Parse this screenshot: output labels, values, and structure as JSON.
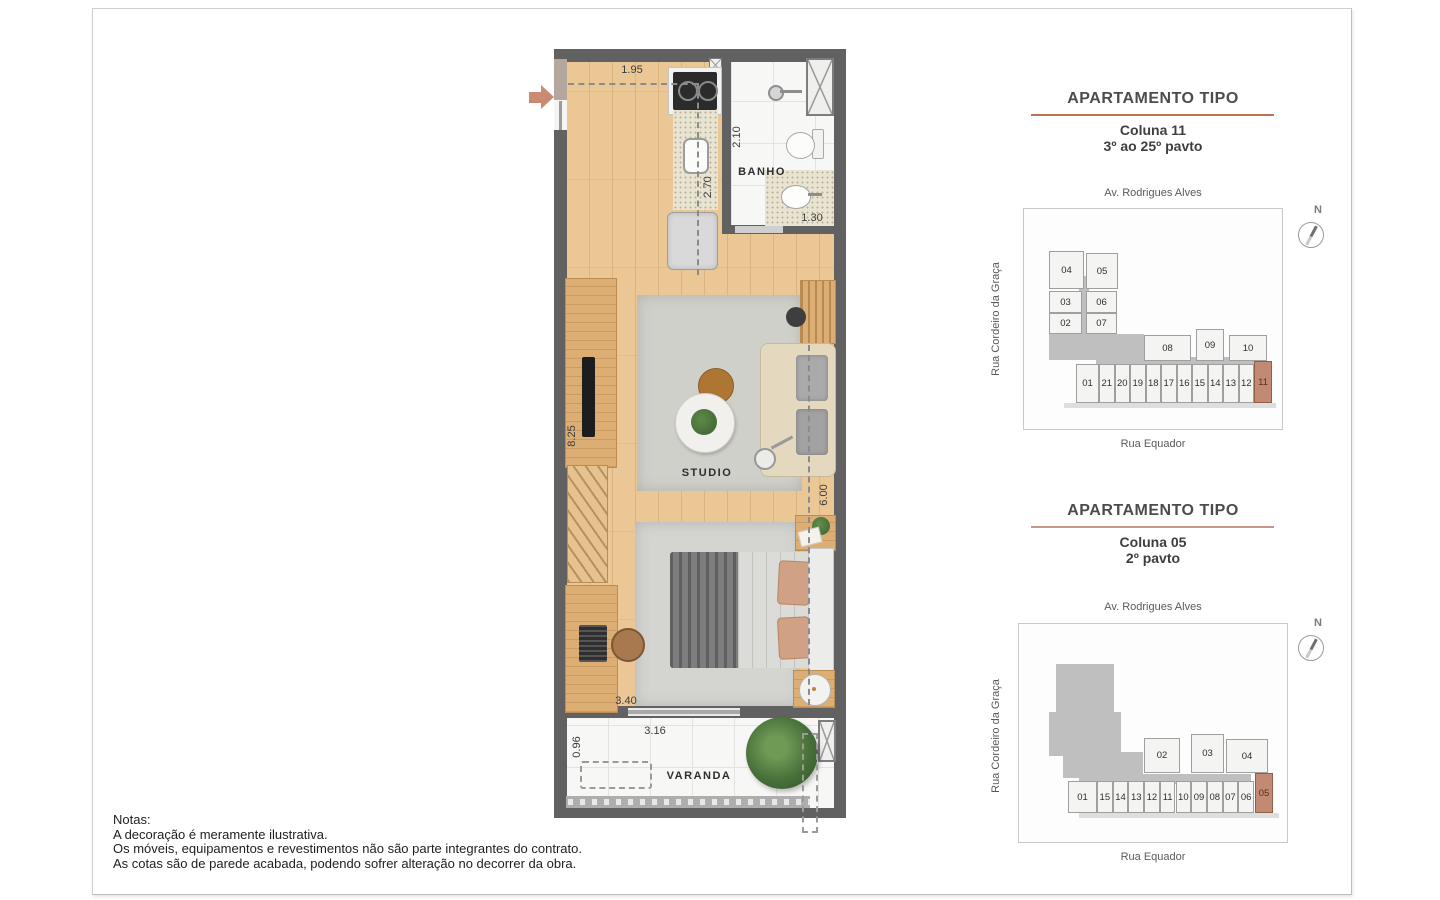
{
  "floor_plan": {
    "rooms": {
      "bath": "BANHO",
      "studio": "STUDIO",
      "balcony": "VARANDA"
    },
    "dimensions": {
      "kitchen_width": "1.95",
      "bath_length": "2.10",
      "kitchen_depth": "2.70",
      "bath_width": "1.30",
      "studio_length": "8.25",
      "studio_depth": "6.00",
      "bedroom_width": "3.40",
      "balcony_width": "3.16",
      "balcony_depth": "0.96"
    }
  },
  "sections": [
    {
      "title": "APARTAMENTO TIPO",
      "column": "Coluna 11",
      "floors": "3º ao 25º pavto",
      "street_top": "Av. Rodrigues Alves",
      "street_left": "Rua Cordeiro da Graça",
      "street_bottom": "Rua Equador",
      "compass": "N",
      "keyplan": {
        "highlight": "11",
        "cluster_units": [
          "04",
          "05",
          "03",
          "06",
          "02",
          "07"
        ],
        "mid_units": [
          "08",
          "09",
          "10"
        ],
        "bottom_units": [
          "01",
          "21",
          "20",
          "19",
          "18",
          "17",
          "16",
          "15",
          "14",
          "13",
          "12",
          "11"
        ]
      }
    },
    {
      "title": "APARTAMENTO TIPO",
      "column": "Coluna 05",
      "floors": "2º pavto",
      "street_top": "Av. Rodrigues Alves",
      "street_left": "Rua Cordeiro da Graça",
      "street_bottom": "Rua Equador",
      "compass": "N",
      "keyplan": {
        "highlight": "05",
        "cluster_units": [],
        "mid_units": [
          "02",
          "03",
          "04"
        ],
        "bottom_units": [
          "01",
          "15",
          "14",
          "13",
          "12",
          "11",
          "10",
          "09",
          "08",
          "07",
          "06",
          "05"
        ]
      }
    }
  ],
  "notes": {
    "title": "Notas:",
    "lines": [
      "A decoração é meramente ilustrativa.",
      "Os móveis, equipamentos e revestimentos não são parte integrantes do contrato.",
      "As cotas são de parede acabada, podendo sofrer alteração no decorrer da obra."
    ]
  },
  "colors": {
    "accent_section1": "#c0714f",
    "accent_section2": "#c9968a",
    "unit_highlight": "#c28a72",
    "wall": "#616161",
    "entry_arrow": "#c98b72"
  }
}
